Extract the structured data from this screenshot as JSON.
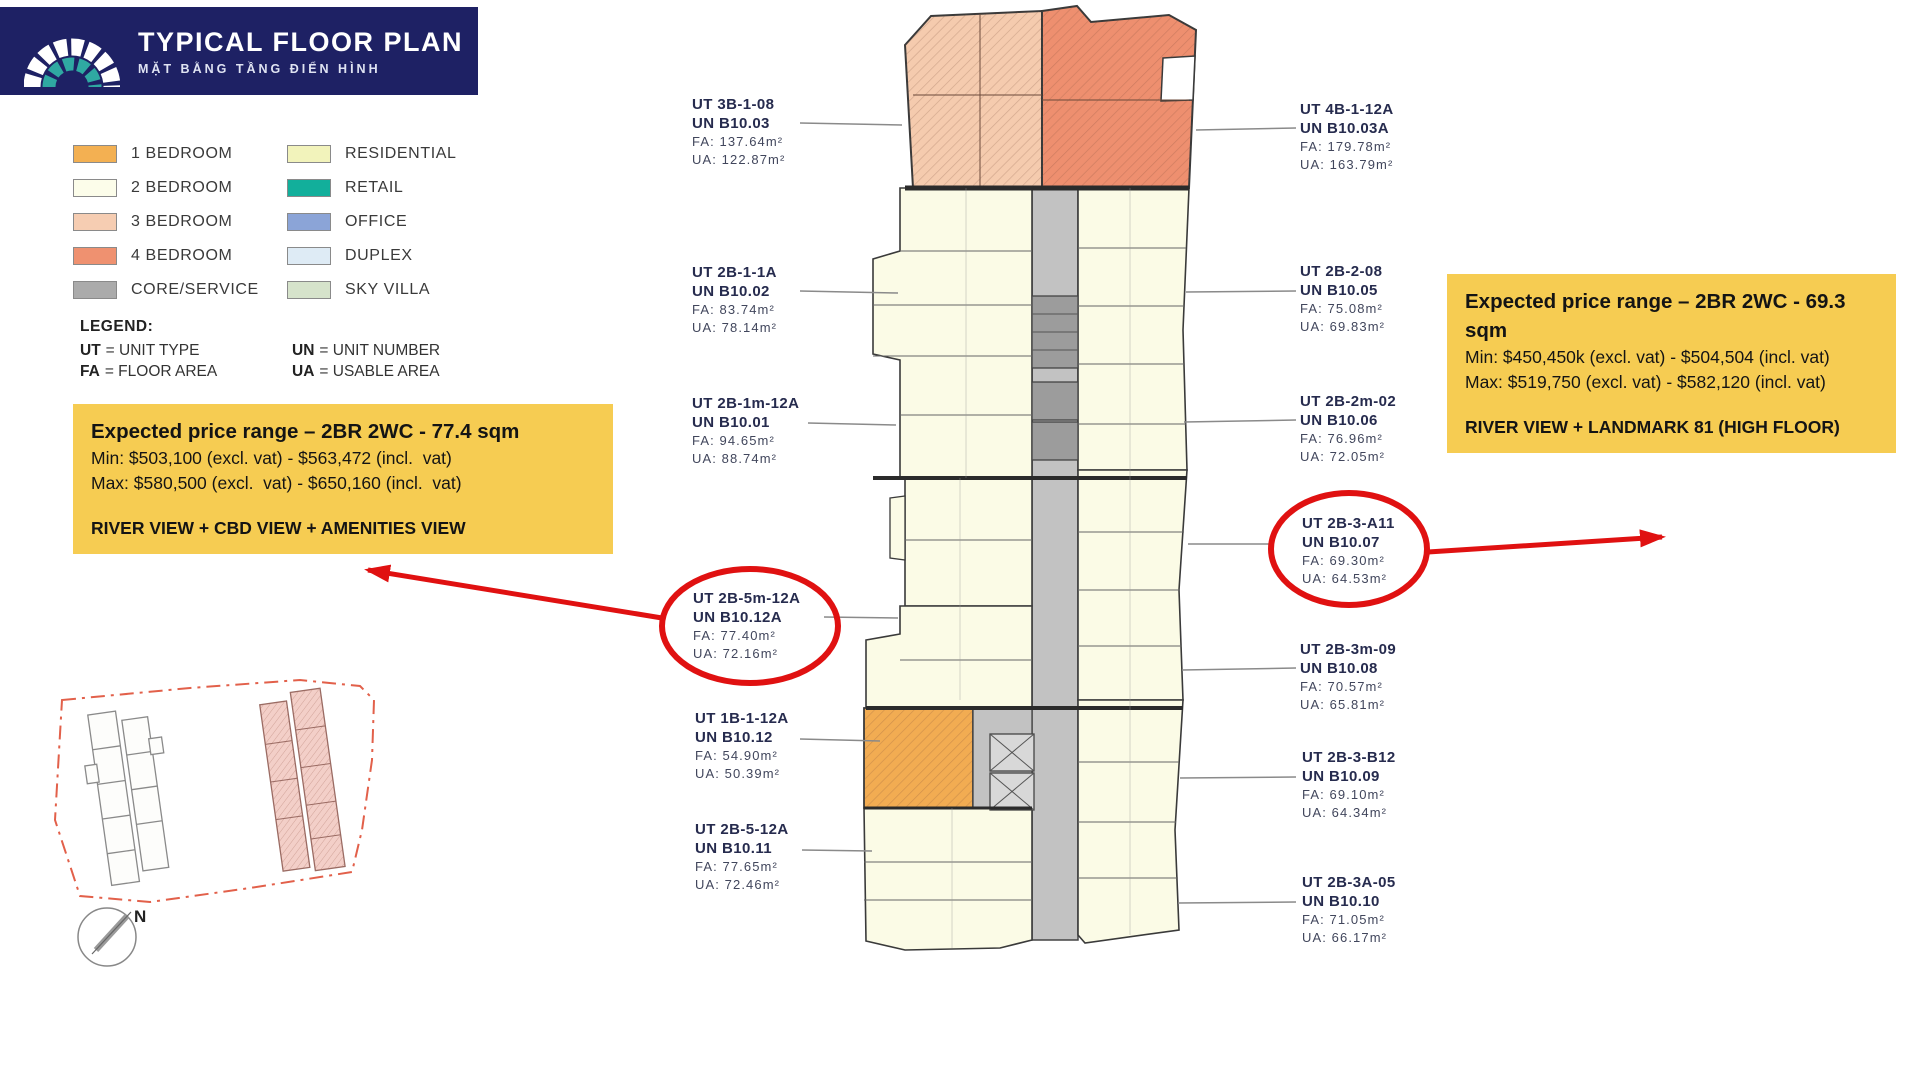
{
  "header": {
    "title": "TYPICAL FLOOR PLAN",
    "subtitle": "MẶT BẰNG TẦNG ĐIỂN HÌNH"
  },
  "legend": {
    "column1": [
      {
        "label": "1 BEDROOM",
        "color": "#F3B052"
      },
      {
        "label": "2 BEDROOM",
        "color": "#FCFDEA"
      },
      {
        "label": "3 BEDROOM",
        "color": "#F6CDB2"
      },
      {
        "label": "4 BEDROOM",
        "color": "#EF9170"
      },
      {
        "label": "CORE/SERVICE",
        "color": "#ABABAB"
      }
    ],
    "column2": [
      {
        "label": "RESIDENTIAL",
        "color": "#F2F3BB"
      },
      {
        "label": "RETAIL",
        "color": "#12AF9B"
      },
      {
        "label": "OFFICE",
        "color": "#8BA4D7"
      },
      {
        "label": "DUPLEX",
        "color": "#DEEBF5"
      },
      {
        "label": "SKY VILLA",
        "color": "#D6E3CB"
      }
    ],
    "key": {
      "title": "LEGEND:",
      "ut": {
        "abbr": "UT",
        "rest": "= UNIT TYPE"
      },
      "un": {
        "abbr": "UN",
        "rest": "= UNIT NUMBER"
      },
      "fa": {
        "abbr": "FA",
        "rest": "= FLOOR AREA"
      },
      "ua": {
        "abbr": "UA",
        "rest": "= USABLE AREA"
      }
    }
  },
  "callouts": {
    "left": {
      "title": "Expected price range – 2BR 2WC - 77.4 sqm",
      "min_line": "Min: $503,100 (excl. vat) - $563,472 (incl.  vat)",
      "max_line": "Max: $580,500 (excl.  vat) - $650,160 (incl.  vat)",
      "view_line": "RIVER VIEW + CBD VIEW + AMENITIES VIEW"
    },
    "right": {
      "title": "Expected price range – 2BR 2WC - 69.3 sqm",
      "min_line": "Min: $450,450k (excl. vat) - $504,504 (incl. vat)",
      "max_line": "Max: $519,750 (excl. vat) - $582,120 (incl. vat)",
      "view_line": "RIVER VIEW + LANDMARK 81 (HIGH FLOOR)"
    }
  },
  "units_left": [
    {
      "ut": "UT 3B-1-08",
      "un": "UN B10.03",
      "fa": "FA: 137.64m²",
      "ua": "UA: 122.87m²",
      "circled": false
    },
    {
      "ut": "UT 2B-1-1A",
      "un": "UN B10.02",
      "fa": "FA: 83.74m²",
      "ua": "UA: 78.14m²",
      "circled": false
    },
    {
      "ut": "UT 2B-1m-12A",
      "un": "UN B10.01",
      "fa": "FA: 94.65m²",
      "ua": "UA: 88.74m²",
      "circled": false
    },
    {
      "ut": "UT 2B-5m-12A",
      "un": "UN B10.12A",
      "fa": "FA: 77.40m²",
      "ua": "UA: 72.16m²",
      "circled": true
    },
    {
      "ut": "UT 1B-1-12A",
      "un": "UN B10.12",
      "fa": "FA: 54.90m²",
      "ua": "UA: 50.39m²",
      "circled": false
    },
    {
      "ut": "UT 2B-5-12A",
      "un": "UN B10.11",
      "fa": "FA: 77.65m²",
      "ua": "UA: 72.46m²",
      "circled": false
    }
  ],
  "units_right": [
    {
      "ut": "UT 4B-1-12A",
      "un": "UN B10.03A",
      "fa": "FA: 179.78m²",
      "ua": "UA: 163.79m²",
      "circled": false
    },
    {
      "ut": "UT 2B-2-08",
      "un": "UN B10.05",
      "fa": "FA: 75.08m²",
      "ua": "UA: 69.83m²",
      "circled": false
    },
    {
      "ut": "UT 2B-2m-02",
      "un": "UN B10.06",
      "fa": "FA: 76.96m²",
      "ua": "UA: 72.05m²",
      "circled": false
    },
    {
      "ut": "UT 2B-3-A11",
      "un": "UN B10.07",
      "fa": "FA: 69.30m²",
      "ua": "UA: 64.53m²",
      "circled": true
    },
    {
      "ut": "UT 2B-3m-09",
      "un": "UN B10.08",
      "fa": "FA: 70.57m²",
      "ua": "UA: 65.81m²",
      "circled": false
    },
    {
      "ut": "UT 2B-3-B12",
      "un": "UN B10.09",
      "fa": "FA: 69.10m²",
      "ua": "UA: 64.34m²",
      "circled": false
    },
    {
      "ut": "UT 2B-3A-05",
      "un": "UN B10.10",
      "fa": "FA: 71.05m²",
      "ua": "UA: 66.17m²",
      "circled": false
    }
  ],
  "site_map": {
    "north_label": "N"
  },
  "annotations": {
    "highlight_color": "#E01111",
    "callout_bg": "#F6CC52",
    "header_bg": "#1E2164"
  }
}
